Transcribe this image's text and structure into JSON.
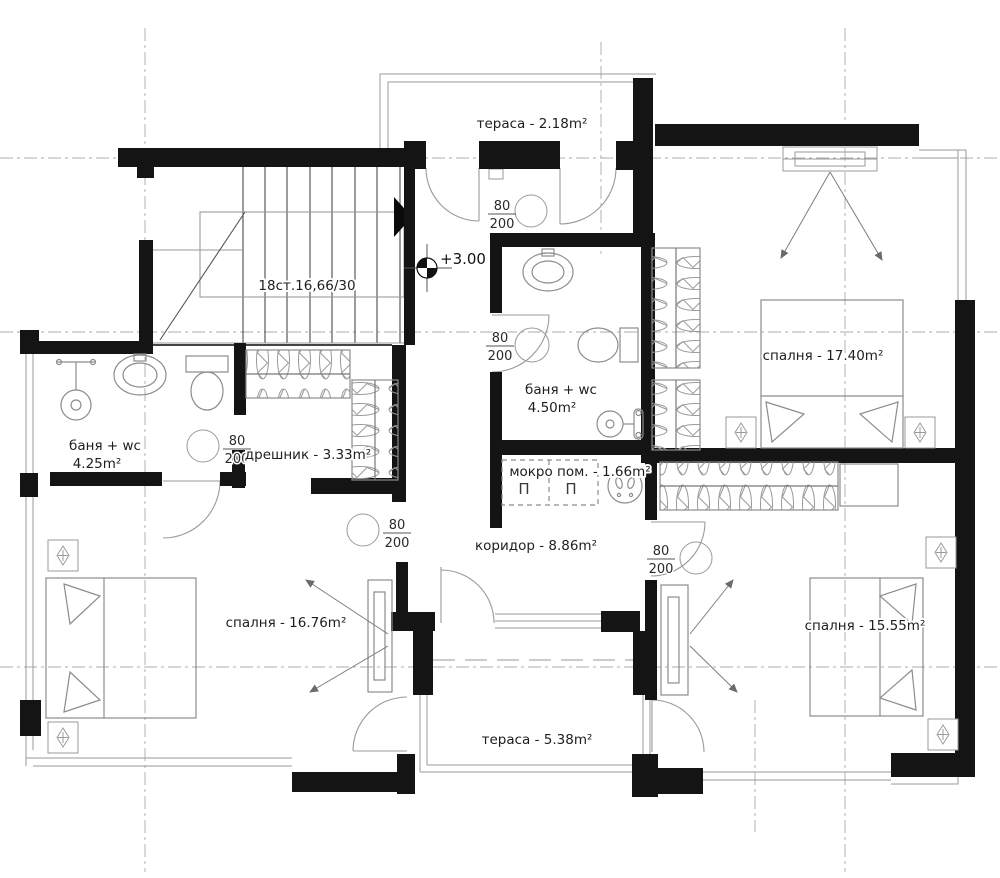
{
  "plan_type": "floor-plan",
  "elevation": {
    "value": "+3.00"
  },
  "stairs": {
    "label": "18ст.16,66/30"
  },
  "door_marker": {
    "width": "80",
    "height": "200",
    "count": 5
  },
  "rooms": [
    {
      "id": "terrace-top",
      "label": "тераса - 2.18m²"
    },
    {
      "id": "bedroom-right",
      "label": "спалня - 17.40m²"
    },
    {
      "id": "bathroom-center",
      "label": "баня + wc",
      "area": "4.50m²"
    },
    {
      "id": "wet-room",
      "label": "мокро пом. - 1.66m²"
    },
    {
      "id": "corridor",
      "label": "коридор - 8.86m²"
    },
    {
      "id": "bathroom-left",
      "label": "баня + wc",
      "area": "4.25m²"
    },
    {
      "id": "closet",
      "label": "дрешник - 3.33m²"
    },
    {
      "id": "bedroom-left",
      "label": "спалня - 16.76m²"
    },
    {
      "id": "bedroom-bottom-right",
      "label": "спалня - 15.55m²"
    },
    {
      "id": "terrace-bottom",
      "label": "тераса - 5.38m²"
    }
  ],
  "wet_room_symbols": [
    "П",
    "П"
  ],
  "colors": {
    "background": "#ffffff",
    "walls": "#141414",
    "thin_lines": "#9a9a9a",
    "furniture": "#8c8c8c",
    "axis": "#aaaaaa",
    "text": "#1e1e1e"
  }
}
